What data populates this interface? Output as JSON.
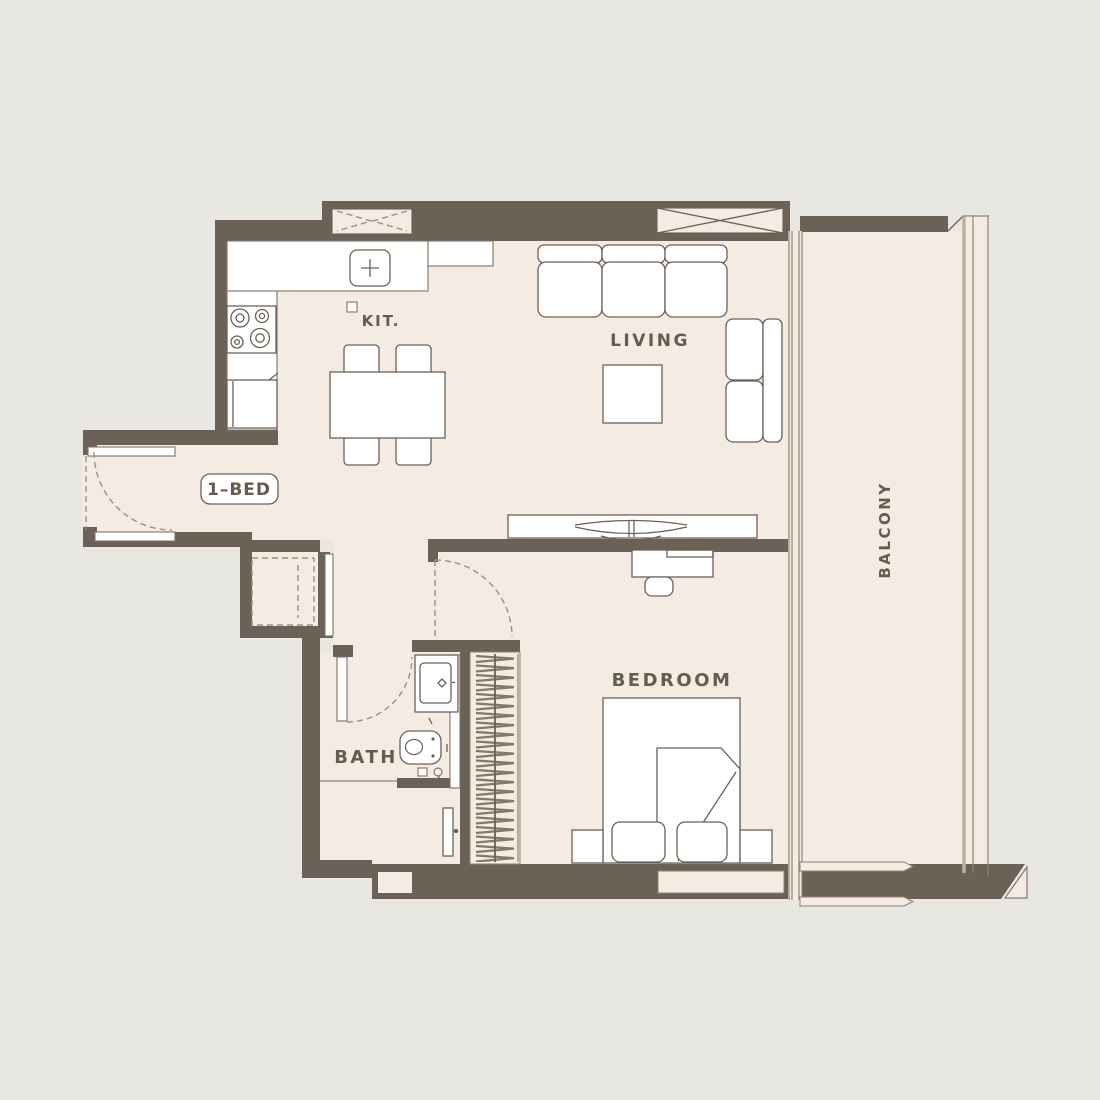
{
  "title": "1-bedroom apartment floor plan",
  "unit_badge": "1–BED",
  "rooms": {
    "kitchen": "KIT.",
    "living": "LIVING",
    "bedroom": "BEDROOM",
    "bath": "BATH",
    "balcony": "BALCONY"
  },
  "colors": {
    "background": "#e9e7e2",
    "floor": "#f4ebe2",
    "wall": "#6b6156",
    "fixture_fill": "#ffffff",
    "label_text": "#655c4f",
    "dashed_line": "#9b9081"
  }
}
